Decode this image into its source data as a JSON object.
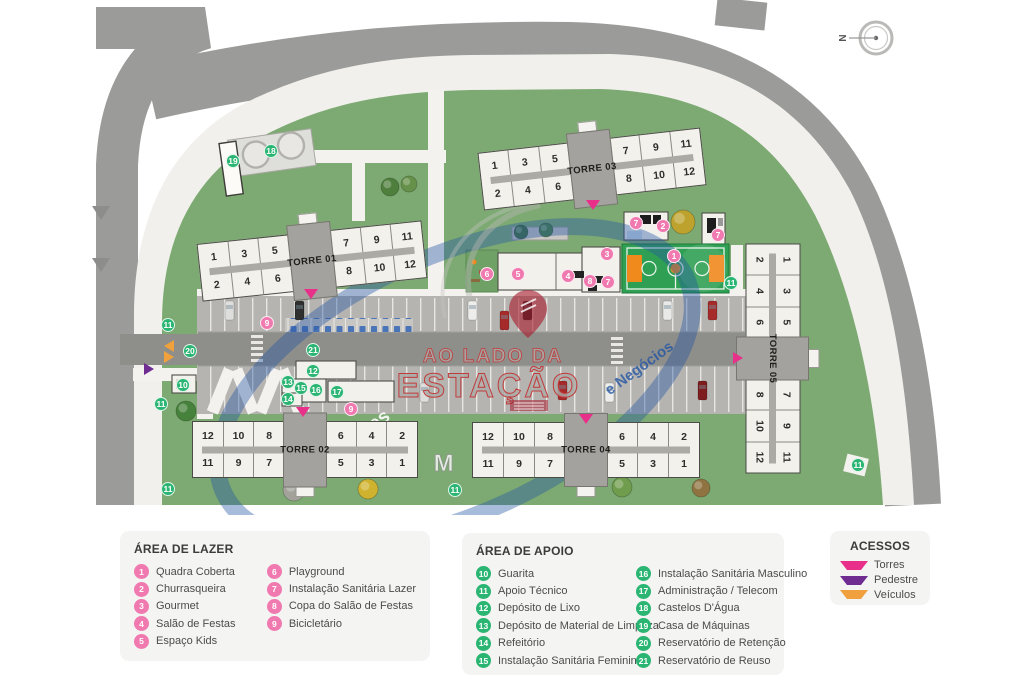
{
  "colors": {
    "grass": "#7daa72",
    "road": "#9b9b99",
    "sidewalk": "#f1f0ec",
    "lot": "#b5b4b1",
    "drive": "#8e8e8b",
    "building": "#f2f1ec",
    "building_core": "#a3a29e",
    "court_green": "#2fa053",
    "court_orange": "#f08a1d",
    "badge_lazer": "#f07ab0",
    "badge_apoio": "#2bb573",
    "access_torres": "#e8308a",
    "access_pedestre": "#6f2c91",
    "access_veiculos": "#f0a03c",
    "watermark_blue": "#2456a4",
    "watermark_red": "#a81e2e"
  },
  "compass": {
    "label": "N"
  },
  "towers": [
    {
      "name": "TORRE 01",
      "top_row": [
        "1",
        "3",
        "5",
        "7",
        "9",
        "11"
      ],
      "bottom_row": [
        "2",
        "4",
        "6",
        "8",
        "10",
        "12"
      ]
    },
    {
      "name": "TORRE 02",
      "top_row": [
        "12",
        "10",
        "8",
        "6",
        "4",
        "2"
      ],
      "bottom_row": [
        "11",
        "9",
        "7",
        "5",
        "3",
        "1"
      ]
    },
    {
      "name": "TORRE 03",
      "top_row": [
        "1",
        "3",
        "5",
        "7",
        "9",
        "11"
      ],
      "bottom_row": [
        "2",
        "4",
        "6",
        "8",
        "10",
        "12"
      ]
    },
    {
      "name": "TORRE 04",
      "top_row": [
        "12",
        "10",
        "8",
        "6",
        "4",
        "2"
      ],
      "bottom_row": [
        "11",
        "9",
        "7",
        "5",
        "3",
        "1"
      ]
    },
    {
      "name": "TORRE 05",
      "top_row": [
        "1",
        "3",
        "5",
        "7",
        "9",
        "11"
      ],
      "bottom_row": [
        "2",
        "4",
        "6",
        "8",
        "10",
        "12"
      ]
    }
  ],
  "map_markers": {
    "badges": [
      {
        "t": "p",
        "n": "1",
        "x": 674,
        "y": 256
      },
      {
        "t": "p",
        "n": "2",
        "x": 663,
        "y": 226
      },
      {
        "t": "p",
        "n": "3",
        "x": 607,
        "y": 254
      },
      {
        "t": "p",
        "n": "4",
        "x": 568,
        "y": 276
      },
      {
        "t": "p",
        "n": "5",
        "x": 518,
        "y": 274
      },
      {
        "t": "p",
        "n": "6",
        "x": 487,
        "y": 274
      },
      {
        "t": "p",
        "n": "7",
        "x": 636,
        "y": 223
      },
      {
        "t": "p",
        "n": "7",
        "x": 718,
        "y": 235
      },
      {
        "t": "p",
        "n": "7",
        "x": 608,
        "y": 282
      },
      {
        "t": "p",
        "n": "8",
        "x": 590,
        "y": 281
      },
      {
        "t": "p",
        "n": "9",
        "x": 267,
        "y": 323
      },
      {
        "t": "p",
        "n": "9",
        "x": 351,
        "y": 409
      },
      {
        "t": "g",
        "n": "10",
        "x": 183,
        "y": 385
      },
      {
        "t": "g",
        "n": "11",
        "x": 168,
        "y": 325
      },
      {
        "t": "g",
        "n": "11",
        "x": 161,
        "y": 404
      },
      {
        "t": "g",
        "n": "11",
        "x": 168,
        "y": 489
      },
      {
        "t": "g",
        "n": "11",
        "x": 455,
        "y": 490
      },
      {
        "t": "g",
        "n": "11",
        "x": 731,
        "y": 283
      },
      {
        "t": "g",
        "n": "11",
        "x": 858,
        "y": 465
      },
      {
        "t": "g",
        "n": "12",
        "x": 313,
        "y": 371
      },
      {
        "t": "g",
        "n": "13",
        "x": 288,
        "y": 382
      },
      {
        "t": "g",
        "n": "14",
        "x": 288,
        "y": 399
      },
      {
        "t": "g",
        "n": "15",
        "x": 301,
        "y": 388
      },
      {
        "t": "g",
        "n": "16",
        "x": 316,
        "y": 390
      },
      {
        "t": "g",
        "n": "17",
        "x": 337,
        "y": 392
      },
      {
        "t": "g",
        "n": "18",
        "x": 271,
        "y": 151
      },
      {
        "t": "g",
        "n": "19",
        "x": 233,
        "y": 161
      },
      {
        "t": "g",
        "n": "20",
        "x": 190,
        "y": 351
      },
      {
        "t": "g",
        "n": "21",
        "x": 313,
        "y": 350
      }
    ],
    "accesses": [
      {
        "kind": "torres",
        "dir": "down",
        "x": 311,
        "y": 295
      },
      {
        "kind": "torres",
        "dir": "down",
        "x": 593,
        "y": 206
      },
      {
        "kind": "torres",
        "dir": "down",
        "x": 303,
        "y": 413
      },
      {
        "kind": "torres",
        "dir": "down",
        "x": 586,
        "y": 420
      },
      {
        "kind": "torres",
        "dir": "right",
        "x": 740,
        "y": 358
      },
      {
        "kind": "pedestre",
        "dir": "right",
        "x": 151,
        "y": 369
      },
      {
        "kind": "veiculos",
        "dir": "left",
        "x": 171,
        "y": 346
      },
      {
        "kind": "veiculos",
        "dir": "right",
        "x": 171,
        "y": 357
      }
    ]
  },
  "watermark": {
    "line1": "AO LADO DA",
    "line2": "ESTAÇÃO",
    "arc_top": "Os Melhores",
    "arc_bottom": "e Negócios",
    "letters": "IMÓVEIS"
  },
  "legend": {
    "lazer": {
      "title": "ÁREA DE LAZER",
      "items": [
        {
          "num": "1",
          "label": "Quadra Coberta"
        },
        {
          "num": "2",
          "label": "Churrasqueira"
        },
        {
          "num": "3",
          "label": "Gourmet"
        },
        {
          "num": "4",
          "label": "Salão de Festas"
        },
        {
          "num": "5",
          "label": "Espaço Kids"
        },
        {
          "num": "6",
          "label": "Playground"
        },
        {
          "num": "7",
          "label": "Instalação Sanitária Lazer"
        },
        {
          "num": "8",
          "label": "Copa do Salão de Festas"
        },
        {
          "num": "9",
          "label": "Bicicletário"
        }
      ]
    },
    "apoio": {
      "title": "ÁREA DE APOIO",
      "items": [
        {
          "num": "10",
          "label": "Guarita"
        },
        {
          "num": "11",
          "label": "Apoio Técnico"
        },
        {
          "num": "12",
          "label": "Depósito de Lixo"
        },
        {
          "num": "13",
          "label": "Depósito de Material de Limpeza"
        },
        {
          "num": "14",
          "label": "Refeitório"
        },
        {
          "num": "15",
          "label": "Instalação Sanitária Feminino"
        },
        {
          "num": "16",
          "label": "Instalação Sanitária Masculino"
        },
        {
          "num": "17",
          "label": "Administração / Telecom"
        },
        {
          "num": "18",
          "label": "Castelos D'Água"
        },
        {
          "num": "19",
          "label": "Casa de Máquinas"
        },
        {
          "num": "20",
          "label": "Reservatório de Retenção"
        },
        {
          "num": "21",
          "label": "Reservatório de Reuso"
        }
      ]
    },
    "acessos": {
      "title": "ACESSOS",
      "items": [
        {
          "label": "Torres",
          "kind": "torres"
        },
        {
          "label": "Pedestre",
          "kind": "pedestre"
        },
        {
          "label": "Veículos",
          "kind": "veiculos"
        }
      ]
    }
  }
}
